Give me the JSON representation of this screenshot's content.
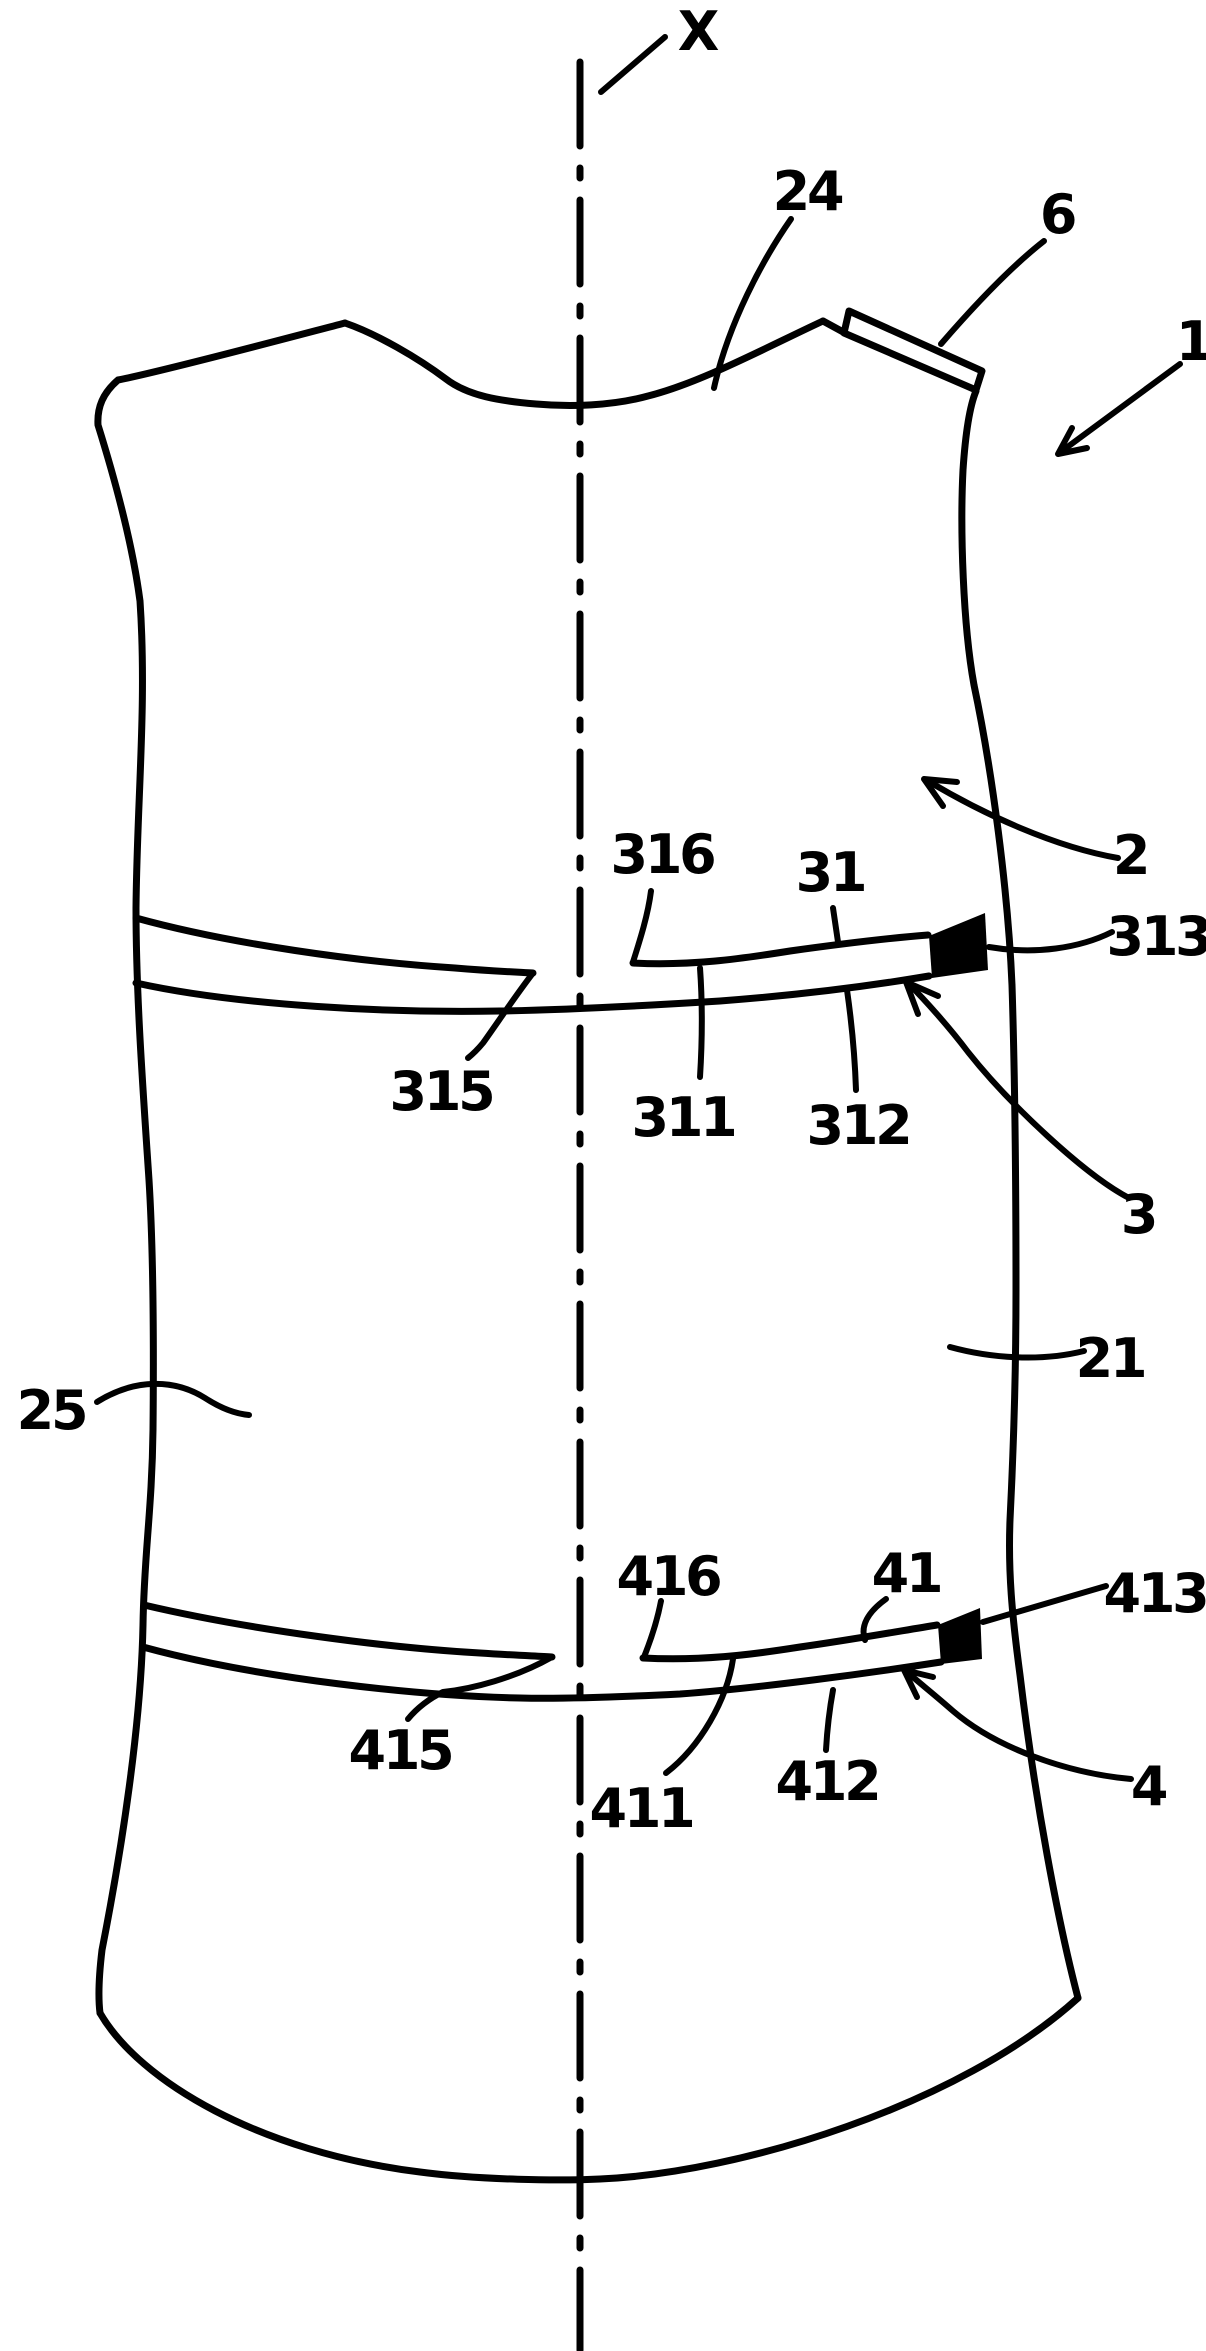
{
  "figure": {
    "background": "#ffffff",
    "ink": "#000000",
    "labels": {
      "axis": "X",
      "ref1": "1",
      "ref2": "2",
      "ref3": "3",
      "ref4": "4",
      "ref6": "6",
      "ref21": "21",
      "ref24": "24",
      "ref25": "25",
      "ref31": "31",
      "ref311": "311",
      "ref312": "312",
      "ref313": "313",
      "ref315": "315",
      "ref316": "316",
      "ref41": "41",
      "ref411": "411",
      "ref412": "412",
      "ref413": "413",
      "ref415": "415",
      "ref416": "416"
    }
  }
}
